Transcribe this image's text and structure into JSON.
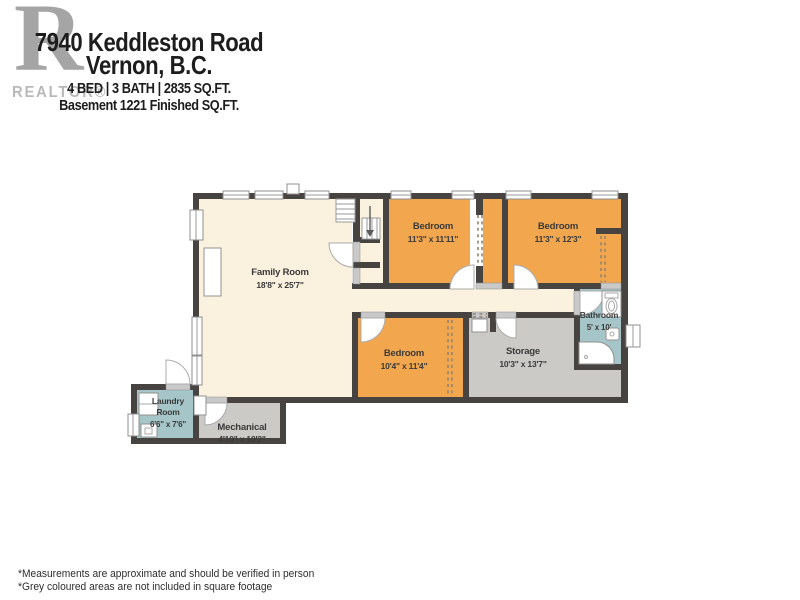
{
  "header": {
    "logo_letter": "R",
    "logo_text": "REALTOR®",
    "address_line1": "7940 Keddleston Road",
    "address_line2": "Vernon, B.C.",
    "stats_line": "4 BED  |  3 BATH  |  2835 SQ.FT.",
    "basement_line": "Basement 1221 Finished SQ.FT."
  },
  "rooms": [
    {
      "name": "Family Room",
      "dims": "18'8\" x 25'7\""
    },
    {
      "name": "Bedroom",
      "dims": "11'3\" x 11'11\""
    },
    {
      "name": "Bedroom",
      "dims": "11'3\" x 12'3\""
    },
    {
      "name": "Bedroom",
      "dims": "10'4\" x 11'4\""
    },
    {
      "name": "Storage",
      "dims": "10'3\" x 13'7\""
    },
    {
      "name": "Bathroom",
      "dims": "5' x 10'"
    },
    {
      "name": "Laundry Room",
      "line1": "Laundry",
      "line2": "Room",
      "dims": "6'6\" x 7'6\""
    },
    {
      "name": "Mechanical",
      "dims": "4'10\" x 10'2\""
    }
  ],
  "footer": {
    "note1": "*Measurements are approximate and should be verified in person",
    "note2": "*Grey coloured areas are not included in square footage"
  },
  "palette": {
    "wall": "#474340",
    "cream": "#faf2df",
    "orange": "#f2a74e",
    "grey_room": "#cbcac7",
    "teal": "#a6c5c8",
    "threshold": "#c9c9c9",
    "label_text": "#3a3a3a",
    "header_text": "#1d1d1d",
    "logo_grey": "#a5a5a5"
  }
}
